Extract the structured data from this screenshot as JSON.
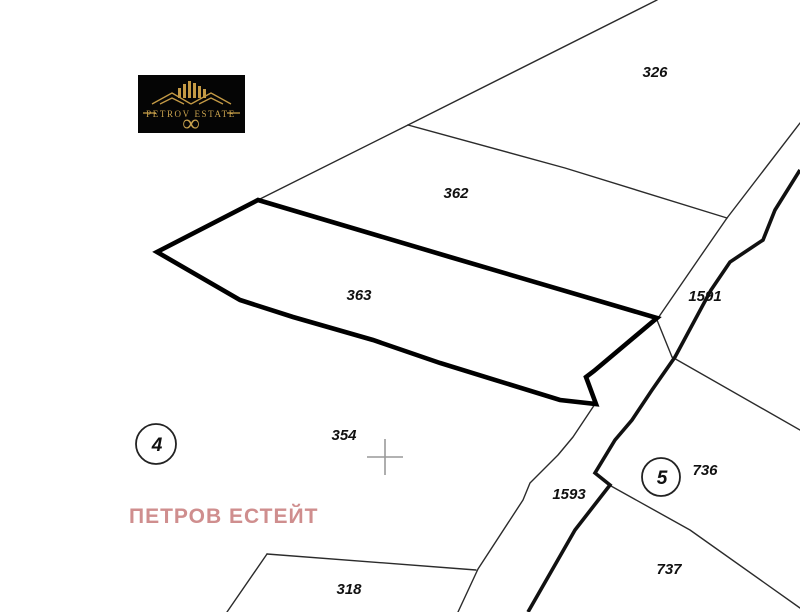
{
  "branding": {
    "logo_text": "PETROV ESTATE",
    "logo_infinity": "∞",
    "watermark_text": "ПЕТРОВ ЕСТЕЙТ"
  },
  "map": {
    "type": "cadastral-plan",
    "highlighted_parcel": "363",
    "parcel_labels": [
      {
        "id": "326"
      },
      {
        "id": "362"
      },
      {
        "id": "363"
      },
      {
        "id": "354"
      },
      {
        "id": "318"
      },
      {
        "id": "736"
      },
      {
        "id": "737"
      },
      {
        "id": "1591"
      },
      {
        "id": "1593"
      }
    ],
    "zone_markers": [
      {
        "number": "4"
      },
      {
        "number": "5"
      }
    ]
  },
  "colors": {
    "background": "#ffffff",
    "boundary_line": "#2b2b2b",
    "highlight_outline": "#000000",
    "road_line": "#111111",
    "cross_marker": "#999999",
    "watermark": "#cf8e8e",
    "logo_background": "#050505",
    "logo_gold": "#c9a24e"
  }
}
